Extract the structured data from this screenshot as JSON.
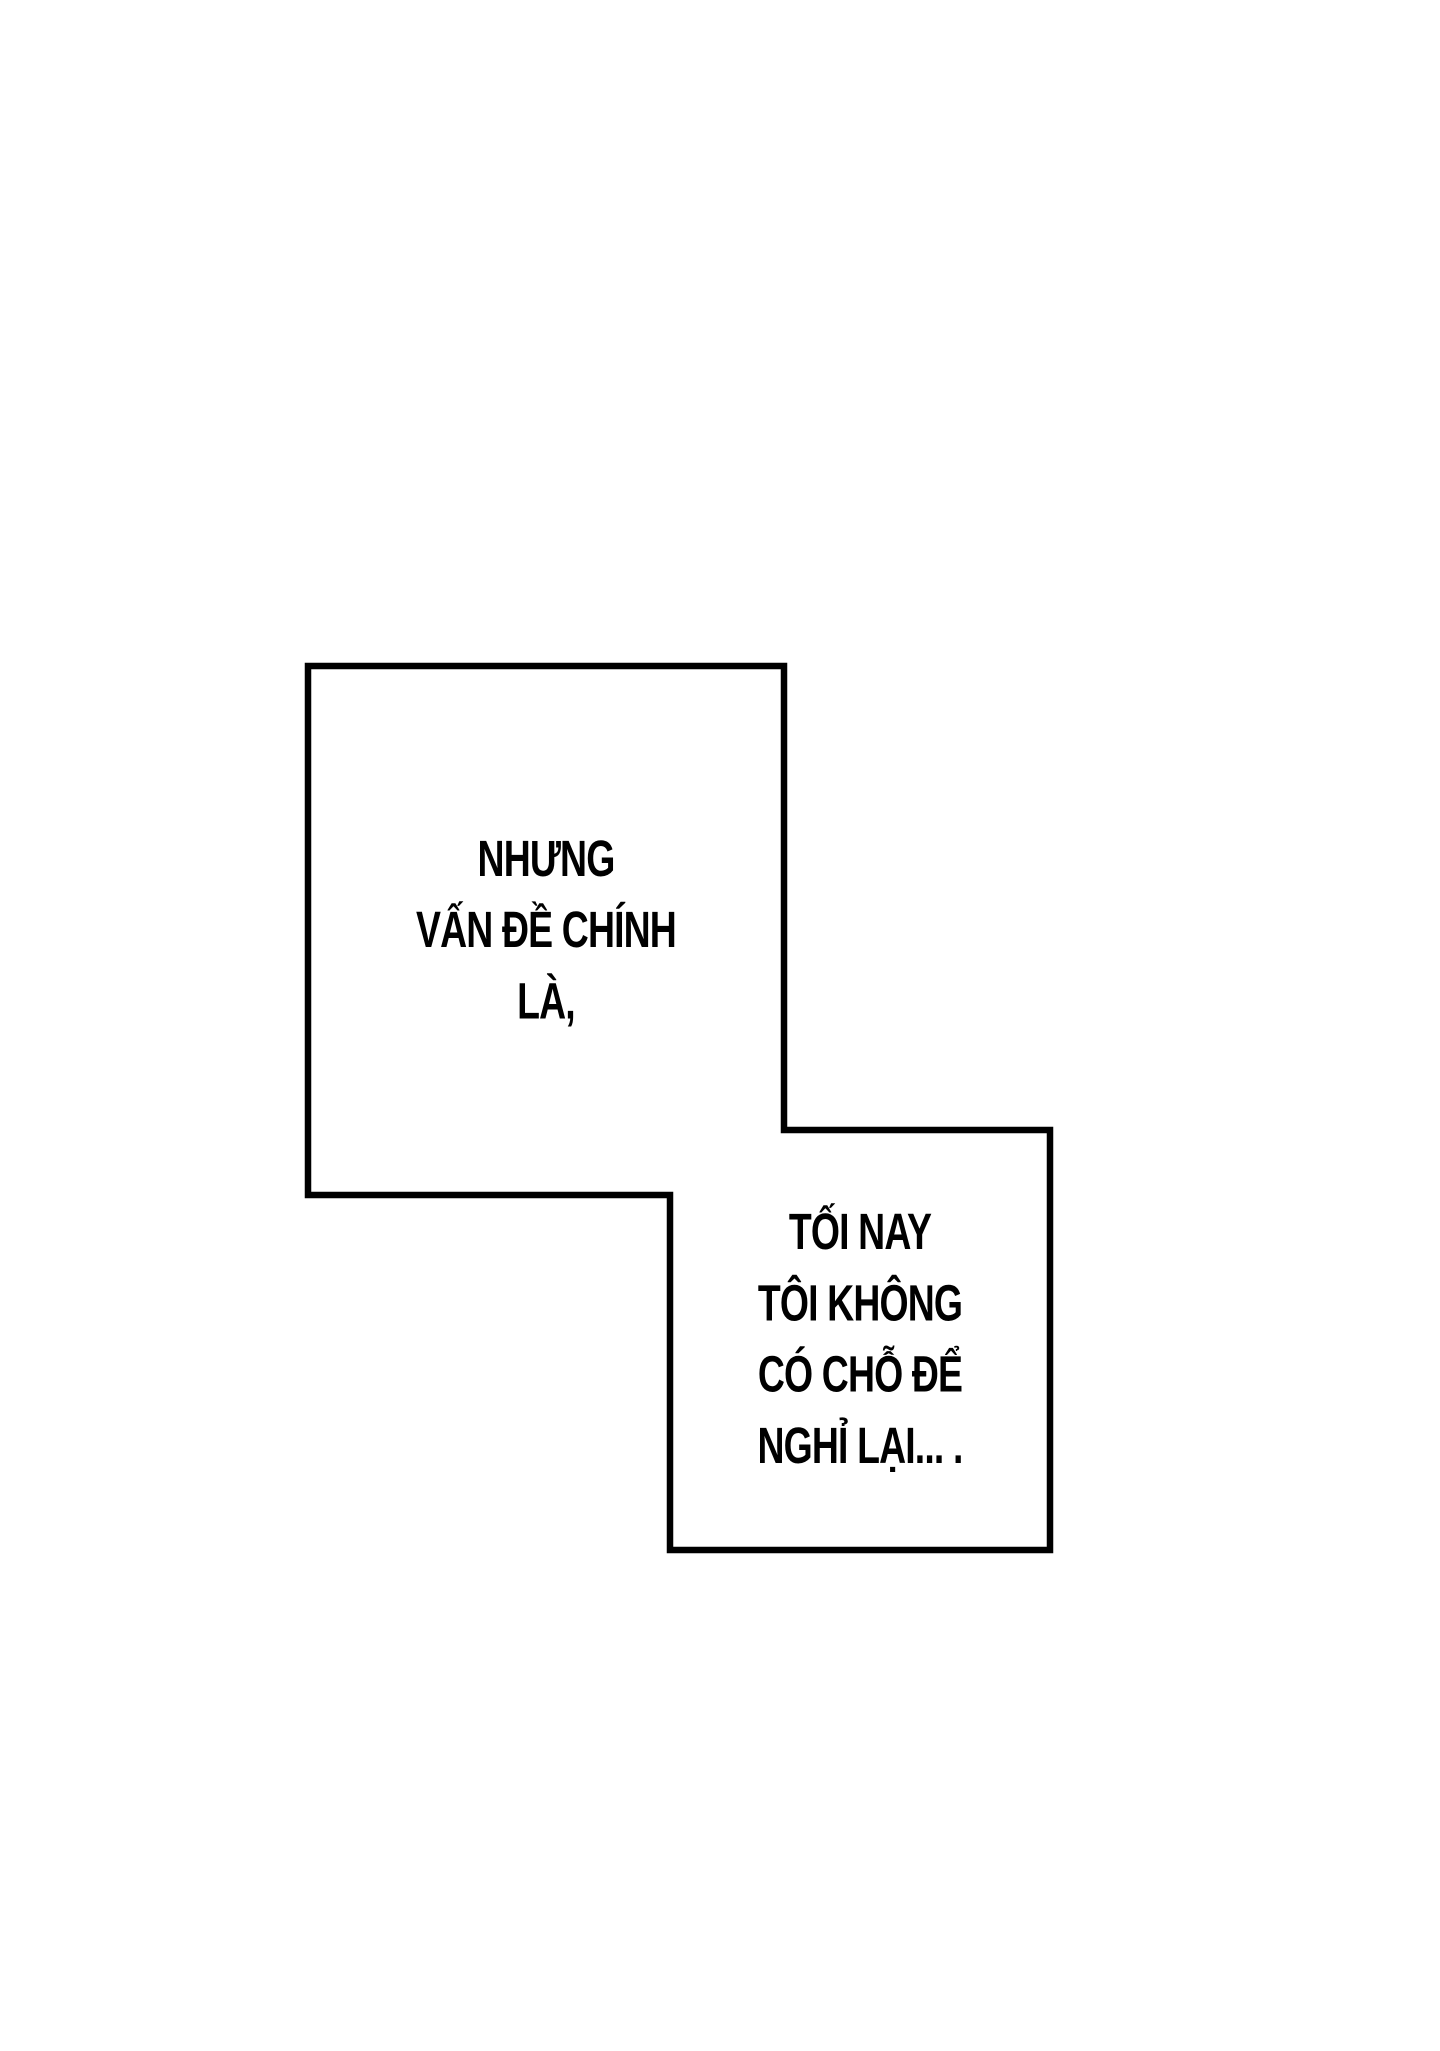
{
  "colors": {
    "ink": "#000000",
    "paper": "#ffffff"
  },
  "panels": [
    {
      "name": "panel-1",
      "lines": [
        "NHƯNG",
        "VẤN ĐỀ CHÍNH",
        "LÀ,"
      ]
    },
    {
      "name": "panel-2",
      "lines": [
        "TỐI NAY",
        "TÔI KHÔNG",
        "CÓ CHỖ ĐỂ",
        "NGHỈ LẠI... ."
      ]
    }
  ]
}
